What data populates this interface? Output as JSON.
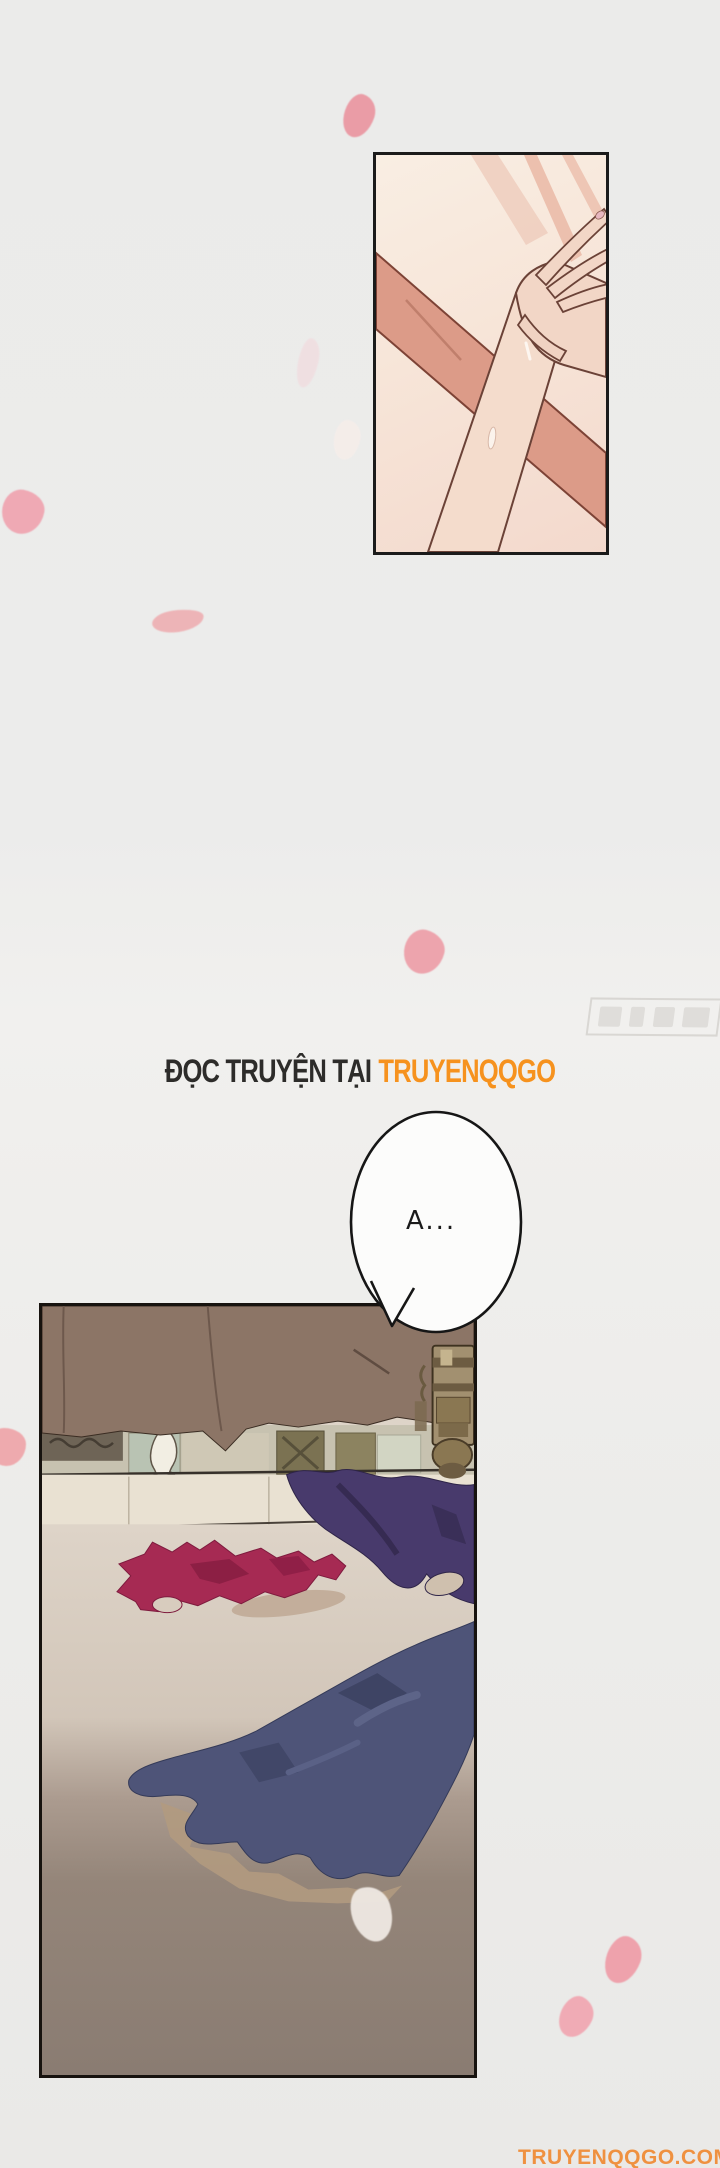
{
  "page": {
    "background": "#ececea"
  },
  "banner": {
    "prefix": "ĐỌC TRUYỆN TẠI",
    "site": "TRUYENQQGO",
    "prefix_color": "#2d2c2a",
    "site_color": "#f6921e"
  },
  "bubble": {
    "text": "A...",
    "fill": "#fcfcfb",
    "outline": "#161616"
  },
  "footer": {
    "site_url": "TRUYENQQGO.COM",
    "color": "#ef9140"
  },
  "artwork_colors": {
    "panel_border": "#1b1b1b",
    "skin_light": "#f3d9cb",
    "skin_dark": "#dc9b88",
    "curtain_brown": "#8c7566",
    "bed_sheet": "#ded4c8",
    "bed_foreground": "#8d7f75",
    "garment_crimson": "#a62a53",
    "garment_purple": "#483a6c",
    "garment_navy": "#4e5478",
    "petal_pink": "#eda4ad"
  },
  "petals": [
    {
      "x": 344,
      "y": 94,
      "w": 30,
      "h": 44,
      "rot": 18,
      "color": "#ea9ca6",
      "opacity": 1
    },
    {
      "x": 334,
      "y": 420,
      "w": 26,
      "h": 40,
      "rot": 10,
      "color": "#f7eee9",
      "opacity": 0.8
    },
    {
      "x": 298,
      "y": 338,
      "w": 20,
      "h": 50,
      "rot": 12,
      "color": "#f3d6da",
      "opacity": 0.55
    },
    {
      "x": 2,
      "y": 490,
      "w": 42,
      "h": 44,
      "rot": 10,
      "color": "#efa9b4",
      "opacity": 1
    },
    {
      "x": 152,
      "y": 610,
      "w": 52,
      "h": 22,
      "rot": -8,
      "color": "#eeafb2",
      "opacity": 0.9
    },
    {
      "x": 404,
      "y": 930,
      "w": 40,
      "h": 44,
      "rot": 14,
      "color": "#eda4ad",
      "opacity": 1
    },
    {
      "x": -12,
      "y": 1428,
      "w": 38,
      "h": 38,
      "rot": 0,
      "color": "#efa7ab",
      "opacity": 0.95
    },
    {
      "x": 352,
      "y": 1886,
      "w": 40,
      "h": 56,
      "rot": -18,
      "color": "#efe9e3",
      "opacity": 0.95
    },
    {
      "x": 606,
      "y": 1936,
      "w": 34,
      "h": 48,
      "rot": 20,
      "color": "#eea2ac",
      "opacity": 1
    },
    {
      "x": 560,
      "y": 1996,
      "w": 32,
      "h": 42,
      "rot": 25,
      "color": "#f0abb5",
      "opacity": 1
    }
  ]
}
